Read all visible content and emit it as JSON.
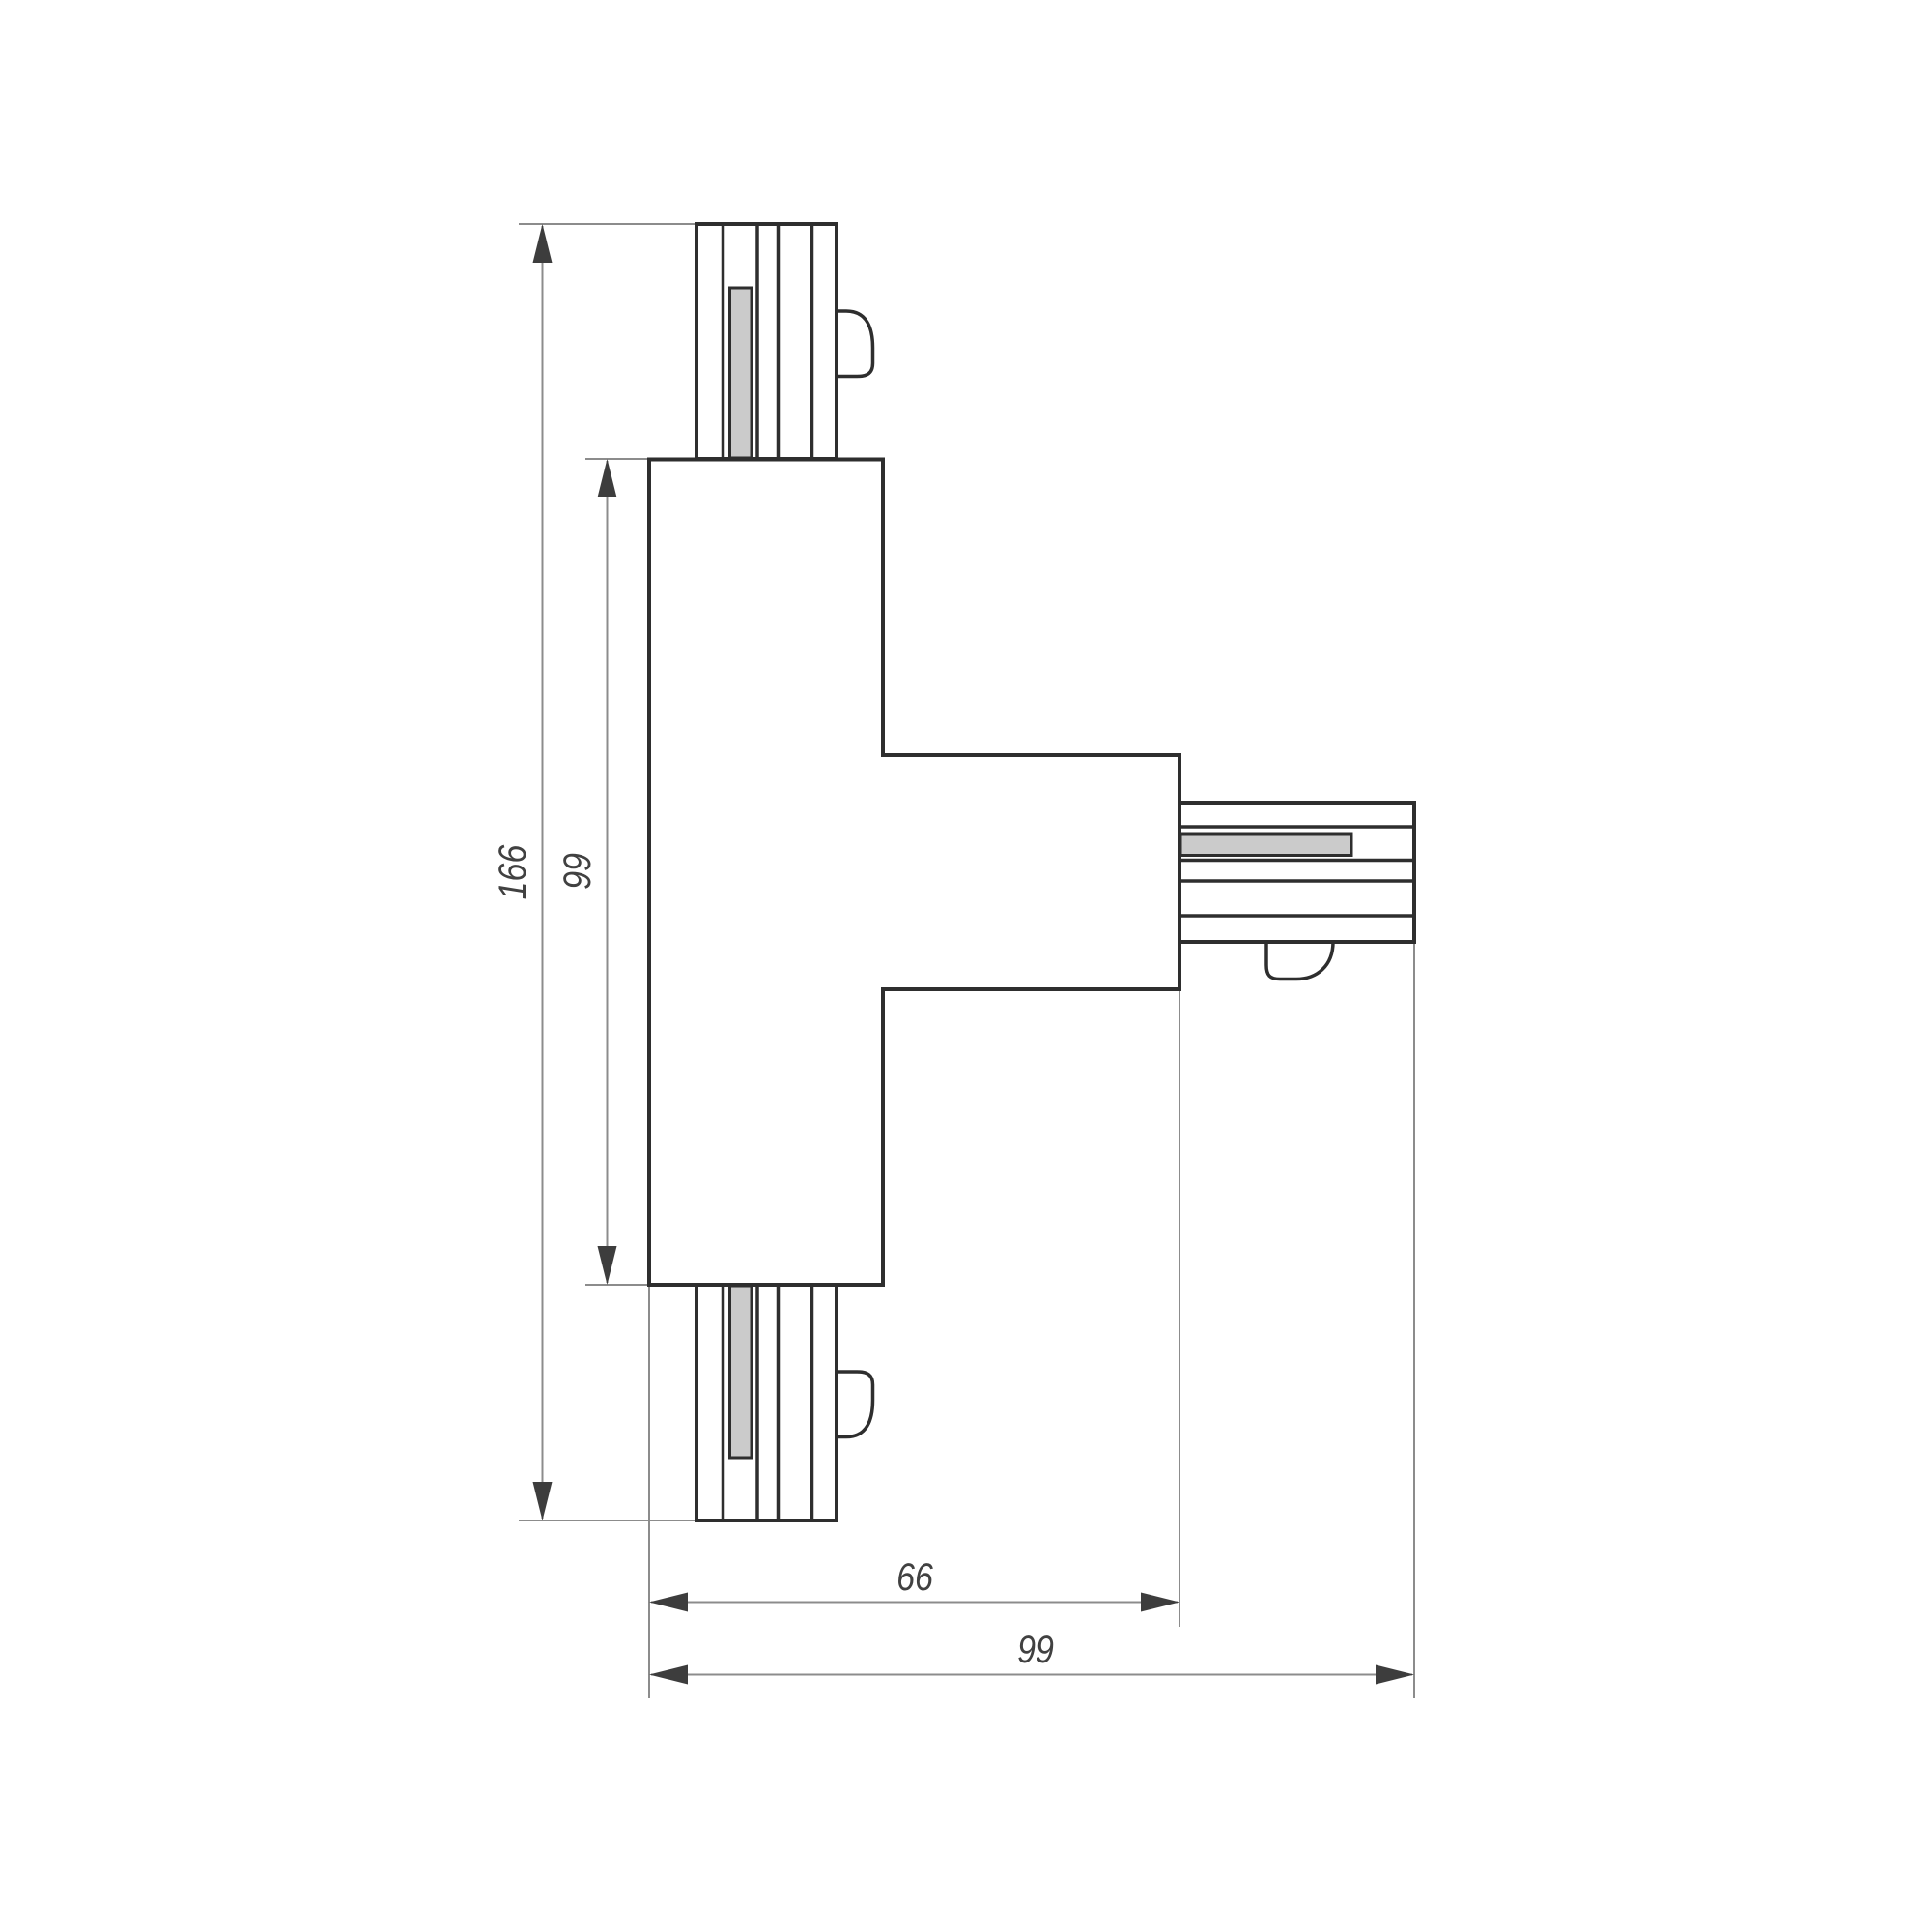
{
  "drawing": {
    "title": "T-shaped track connector — dimensioned top view",
    "background_color": "#ffffff",
    "colors": {
      "object_line": "#2e2e2e",
      "dimension_line": "#8c8c8c",
      "arrowhead": "#3d3d3d",
      "label_text": "#414141",
      "contact_fill": "#cbcbcb"
    },
    "parts": {
      "body": "T-shaped connector body",
      "top_connector": "track end with contact strip and side clip",
      "bottom_connector": "track end with contact strip and side clip",
      "right_connector": "track end with contact strip and bottom clip"
    },
    "dimensions": {
      "total_height": {
        "label": "166"
      },
      "body_height": {
        "label": "99"
      },
      "arm_span": {
        "label": "66"
      },
      "total_width": {
        "label": "99"
      }
    }
  }
}
